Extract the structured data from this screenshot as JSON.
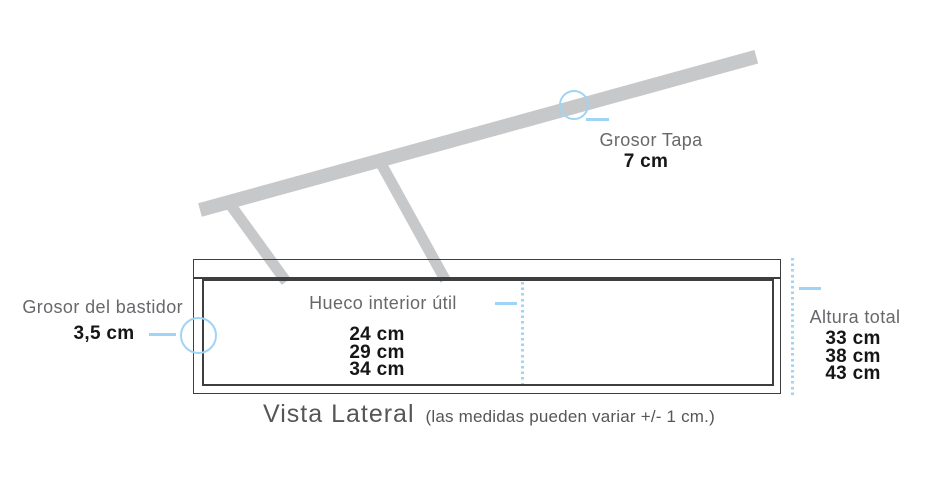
{
  "diagram": {
    "view_title": "Vista Lateral",
    "view_note": "(las medidas pueden variar +/- 1 cm.)",
    "callouts": {
      "grosor_tapa": {
        "label": "Grosor Tapa",
        "value": "7 cm"
      },
      "grosor_bastidor": {
        "label": "Grosor del bastidor",
        "value": "3,5 cm"
      },
      "hueco_interior": {
        "label": "Hueco interior útil",
        "values": [
          "24 cm",
          "29 cm",
          "34 cm"
        ]
      },
      "altura_total": {
        "label": "Altura total",
        "values": [
          "33 cm",
          "38 cm",
          "43 cm"
        ]
      }
    },
    "colors": {
      "accent_blue": "#a0d4f4",
      "wood_gray": "#c7c8c9",
      "outline_dark": "#3d3e40",
      "label_gray": "#67686b",
      "value_dark": "#161617"
    }
  }
}
